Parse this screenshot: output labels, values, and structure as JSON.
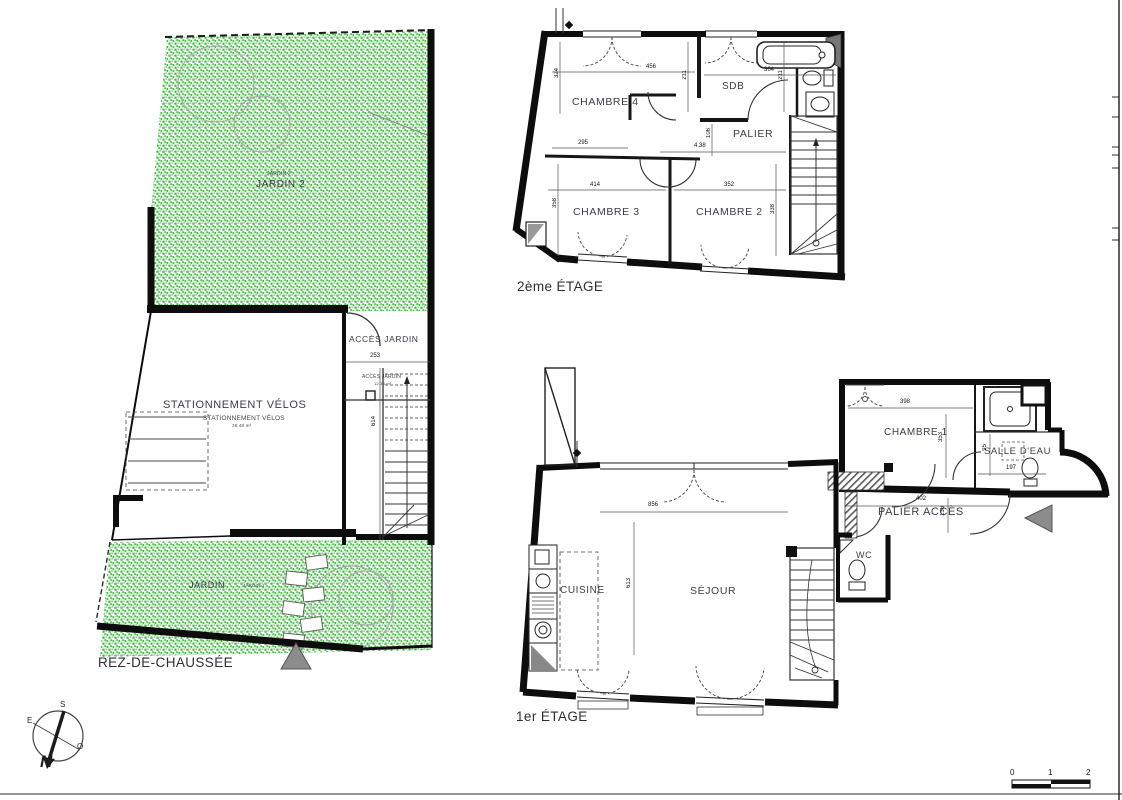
{
  "colors": {
    "garden_green": "#57c057",
    "wall_black": "#0d0d0d",
    "label_color": "#3c3c49",
    "triangle_gray": "#8c8c8c"
  },
  "ground_floor": {
    "title": "REZ-DE-CHAUSSÉE",
    "garden_top_small": "JARDIN 2",
    "garden_top": "JARDIN 2",
    "bike_big": "STATIONNEMENT VÉLOS",
    "bike_small": "STATIONNEMENT VÉLOS",
    "bike_area": "36.48 m²",
    "acces_big": "ACCÈS JARDIN",
    "acces_small": "ACCÈS JARDIN",
    "acces_area": "12.33 m²",
    "garden_bottom": "JARDIN",
    "garden_bottom_small": "JARDIN 1",
    "dims": [
      "253",
      "614"
    ]
  },
  "second_floor": {
    "title": "2ème ÉTAGE",
    "rooms": {
      "chambre4": "CHAMBRE 4",
      "sdb": "SDB",
      "palier": "PALIER",
      "chambre3": "CHAMBRE 3",
      "chambre2": "CHAMBRE 2"
    },
    "dims": [
      "456",
      "364",
      "211",
      "211",
      "324",
      "295",
      "106",
      "4.38",
      "414",
      "352",
      "358",
      "338"
    ]
  },
  "first_floor": {
    "title": "1er ÉTAGE",
    "rooms": {
      "chambre1": "CHAMBRE 1",
      "salle_eau": "SALLE D'EAU",
      "palier_acces": "PALIER ACCÈS",
      "wc": "WC",
      "cuisine": "CUISINE",
      "sejour": "SÉJOUR"
    },
    "dims": [
      "398",
      "353",
      "95",
      "197",
      "402",
      "136",
      "613",
      "856"
    ]
  },
  "compass": {
    "n": "N",
    "s": "S",
    "e": "E",
    "o": "O"
  },
  "scale": {
    "t0": "0",
    "t1": "1",
    "t2": "2"
  }
}
